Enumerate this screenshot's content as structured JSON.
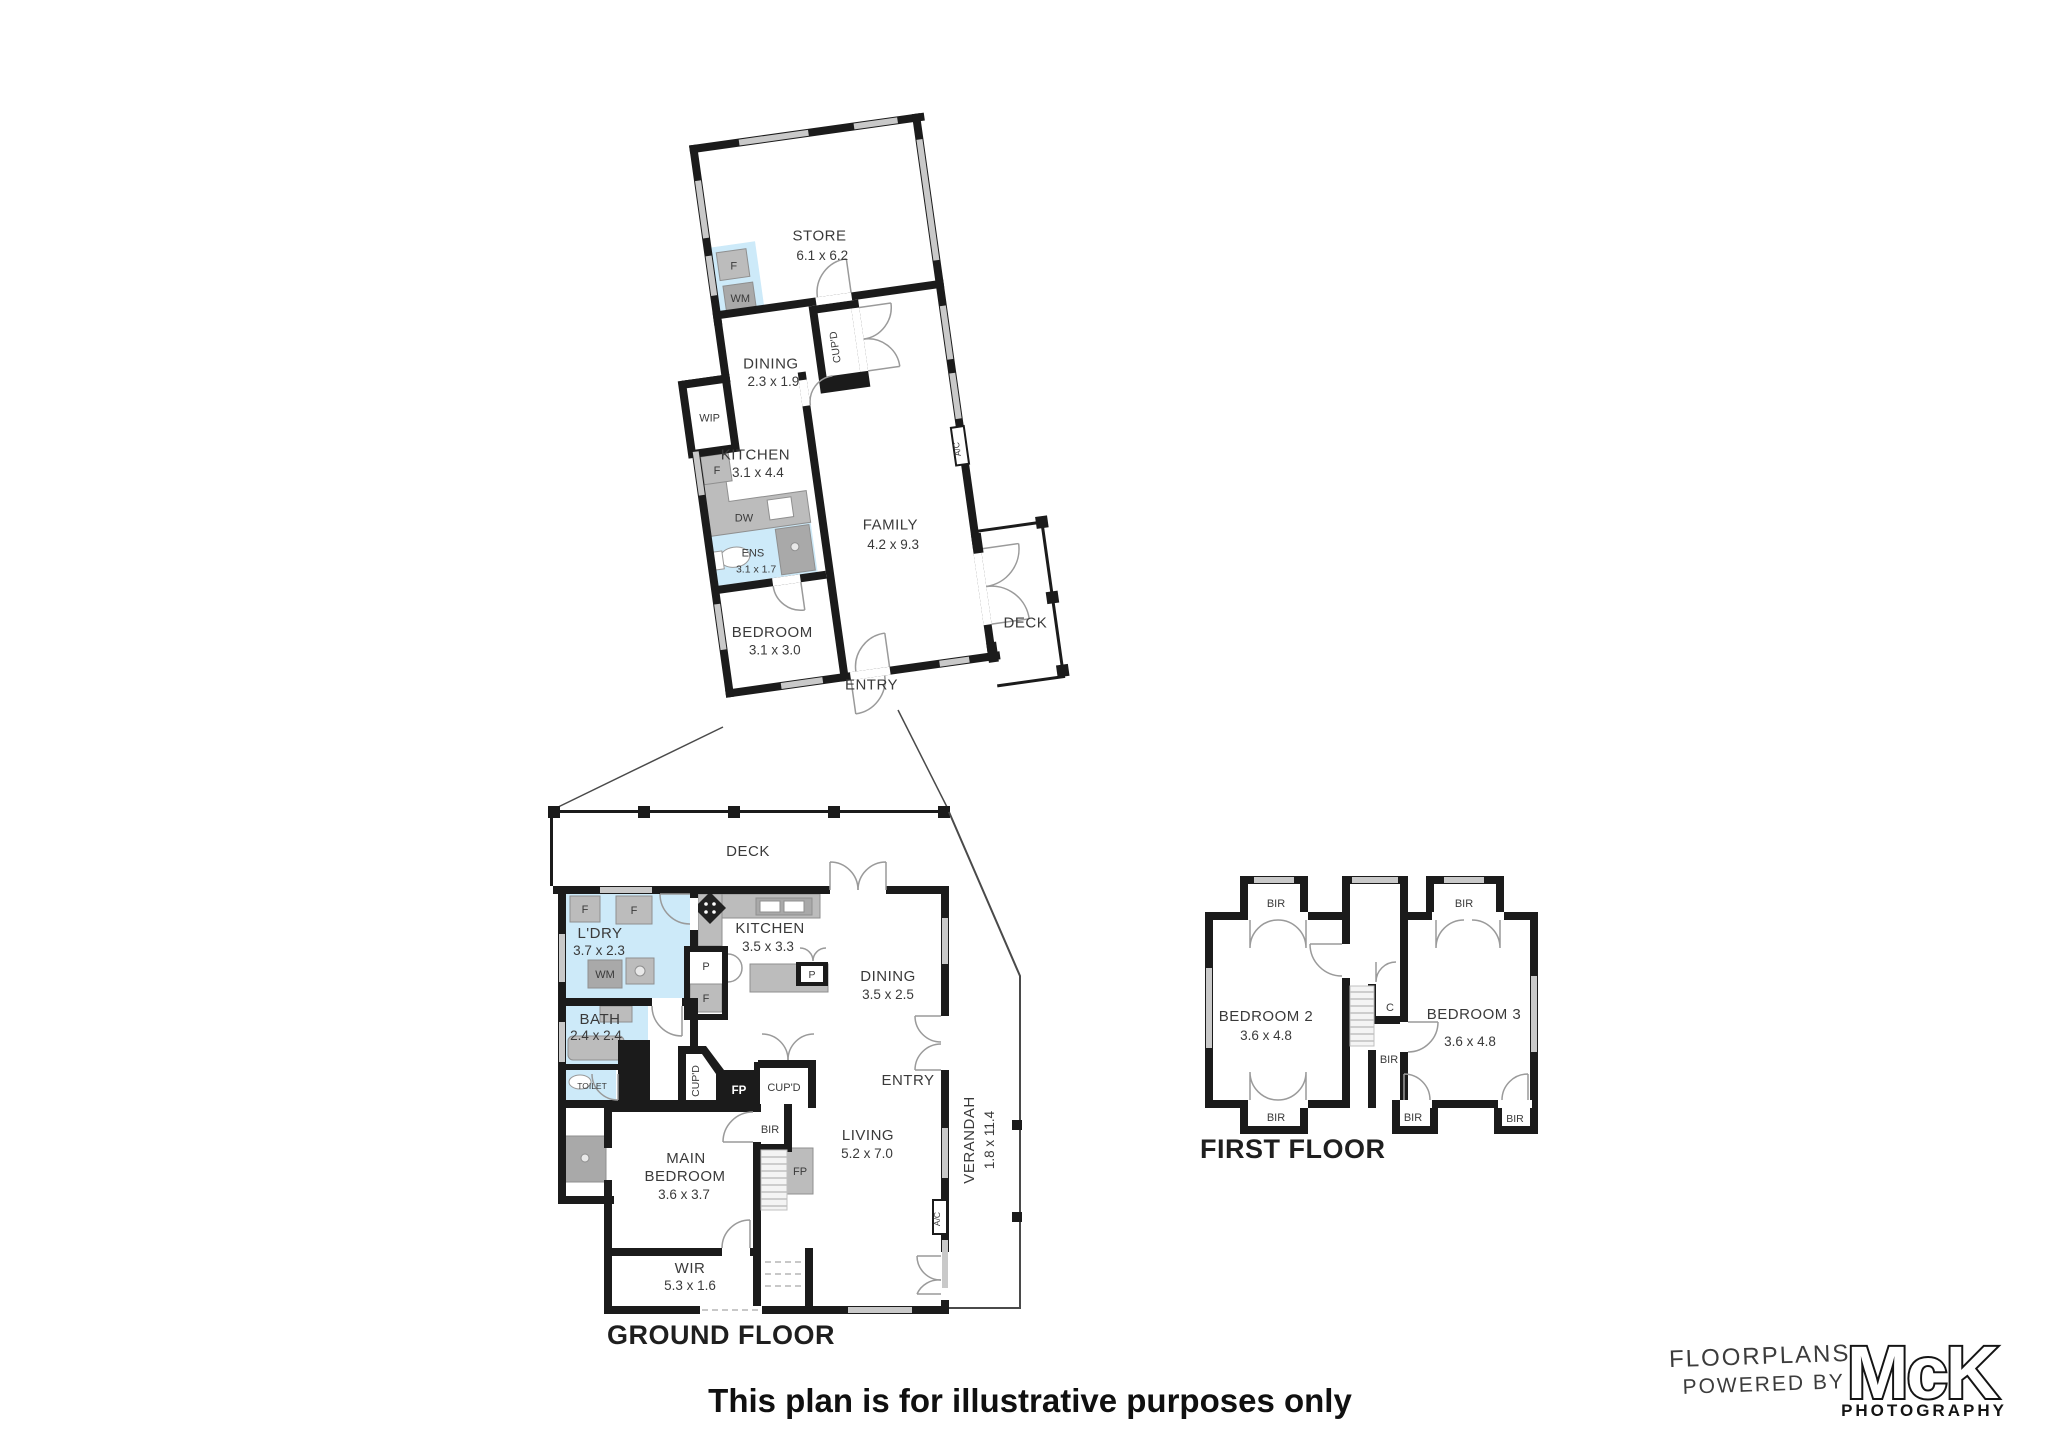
{
  "upper_floor": {
    "store": {
      "name": "STORE",
      "dims": "6.1 x 6.2"
    },
    "fridge": "F",
    "washing_machine": "WM",
    "dining": {
      "name": "DINING",
      "dims": "2.3 x 1.9"
    },
    "wip": "WIP",
    "cupboard": "CUP'D",
    "kitchen": {
      "name": "KITCHEN",
      "dims": "3.1 x 4.4"
    },
    "kitchen_fridge": "F",
    "dishwasher": "DW",
    "ens": {
      "name": "ENS",
      "dims": "3.1 x 1.7"
    },
    "family": {
      "name": "FAMILY",
      "dims": "4.2 x 9.3"
    },
    "bedroom": {
      "name": "BEDROOM",
      "dims": "3.1 x 3.0"
    },
    "entry": "ENTRY",
    "deck": "DECK",
    "aircon": "A/C"
  },
  "ground_floor": {
    "title": "GROUND FLOOR",
    "deck": "DECK",
    "laundry": {
      "name": "L'DRY",
      "dims": "3.7 x 2.3"
    },
    "fridge1": "F",
    "fridge2": "F",
    "washing_machine": "WM",
    "kitchen": {
      "name": "KITCHEN",
      "dims": "3.5 x 3.3"
    },
    "pantry": "P",
    "kitchen_fridge": "F",
    "island_pantry": "P",
    "dining": {
      "name": "DINING",
      "dims": "3.5 x 2.5"
    },
    "bath": {
      "name": "BATH",
      "dims": "2.4 x 2.4"
    },
    "toilet": "TOILET",
    "cupboard_angled": "CUP'D",
    "fireplace": "FP",
    "cupboard": "CUP'D",
    "bir": "BIR",
    "main_bedroom": {
      "line1": "MAIN",
      "line2": "BEDROOM",
      "dims": "3.6 x 3.7"
    },
    "fireplace2": "FP",
    "living": {
      "name": "LIVING",
      "dims": "5.2 x 7.0"
    },
    "entry": "ENTRY",
    "wir": {
      "name": "WIR",
      "dims": "5.3 x 1.6"
    },
    "verandah": {
      "name": "VERANDAH",
      "dims": "1.8 x 11.4"
    },
    "aircon": "A/C"
  },
  "first_floor": {
    "title": "FIRST FLOOR",
    "bedroom2": {
      "name": "BEDROOM 2",
      "dims": "3.6 x 4.8"
    },
    "bedroom3": {
      "name": "BEDROOM 3",
      "dims": "3.6 x 4.8"
    },
    "closet": "C",
    "bir_top_left": "BIR",
    "bir_top_right": "BIR",
    "bir_middle": "BIR",
    "bir_bottom_left": "BIR",
    "bir_bottom_middle": "BIR",
    "bir_bottom_right": "BIR"
  },
  "footer": {
    "disclaimer": "This plan is for illustrative purposes only",
    "logo_floorplans": "FLOORPLANS",
    "logo_powered_by": "POWERED BY",
    "logo_name": "McK",
    "logo_photography": "PHOTOGRAPHY"
  },
  "colors": {
    "wall": "#1b1b1b",
    "wet_area": "#cdeaf9",
    "fixture": "#bcbcbc",
    "window": "#c9c9c9"
  }
}
